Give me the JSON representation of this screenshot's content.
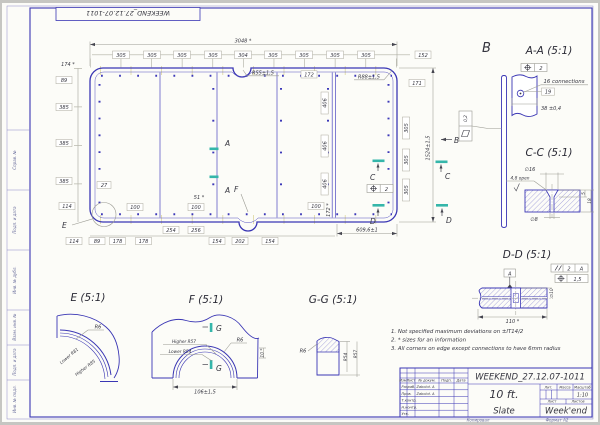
{
  "stamp": "WEEKEND_27.12.07-1011",
  "labels": {
    "a": "A",
    "b": "B",
    "c": "C",
    "d": "D",
    "e": "E",
    "f": "F",
    "g": "G"
  },
  "dims": {
    "overall_width": "3048 *",
    "top_row": [
      "305",
      "305",
      "305",
      "305",
      "304",
      "305",
      "305",
      "305",
      "305"
    ],
    "top_right": "152",
    "right_171": "171",
    "left_174": "174 *",
    "left_89": "89",
    "left_385": "385",
    "left_27": "27",
    "left_114": "114",
    "bottom_row": [
      "114",
      "89",
      "178",
      "178"
    ],
    "mid_254": "254",
    "mid_256": "256",
    "bottom_154": "154",
    "bottom_202": "202",
    "bottom_right": "609,6±1",
    "v172": "172 *",
    "t172": "172",
    "d100": "100",
    "d51": "51 *",
    "d406": "406",
    "r305": "305",
    "overall_height": "1524±1,5",
    "r55": "R55±1,5",
    "r88": "R88±1,5",
    "pos_tol": "2"
  },
  "view_b": {
    "flatness": "0,2"
  },
  "section_aa": {
    "title": "A-A (5:1)",
    "pos_tol": "2",
    "connections": "16 connections",
    "d19": "19",
    "d38": "38 ±0,4"
  },
  "section_cc": {
    "title": "C-C (5:1)",
    "d16": "∅16",
    "open": "4,8 open",
    "d8": "∅8",
    "t5": "5",
    "t18": "18"
  },
  "section_dd": {
    "title": "D-D (5:1)",
    "datum": "A",
    "par_val": "2",
    "par_ref": "A",
    "pos_val": "1,5",
    "d110": "110 *",
    "d10": "∅10"
  },
  "detail_e": {
    "title": "E (5:1)",
    "r6": "R6",
    "lower": "Lower R81",
    "higher": "Higher R85"
  },
  "detail_f": {
    "title": "F (5:1)",
    "higher": "Higher R57",
    "lower": "Lower R54",
    "r6": "R6",
    "d106": "106±1,5",
    "d10": "10 *"
  },
  "section_gg": {
    "title": "G-G (5:1)",
    "r6": "R6",
    "r54": "R54",
    "r57": "R57"
  },
  "notes": [
    "1. Not specified maximum deviations on ±IT14/2",
    "2. * sizes for an information",
    "3. All corners on edge except connections to have 6mm radius"
  ],
  "title_block": {
    "doc_number": "WEEKEND_27.12.07-1011",
    "part_name": "10 ft.",
    "material": "Slate",
    "company": "Week'end",
    "scale": "1:10",
    "col_izm": "Изм.",
    "col_list": "Лист",
    "col_doc": "№ докум.",
    "col_sign": "Подп.",
    "col_date": "Дата",
    "lit": "Лит.",
    "mass": "Масса",
    "scale_lbl": "Масштаб",
    "sheet_lbl": "Лист",
    "sheets_lbl": "Листов",
    "role_0": "Разраб.",
    "role_1": "Пров.",
    "role_2": "Т.контр.",
    "role_3": "Н.контр.",
    "role_4": "Утв.",
    "name_0": "Zabolot. A",
    "name_1": "Zabolot. A",
    "copied": "Копировал",
    "format": "Формат A2"
  },
  "margin": {
    "l0": "Справ. №",
    "l1": "Подп. и дата",
    "l2": "Инв. № дубл.",
    "l3": "Взам. инв. №",
    "l4": "Подп. и дата",
    "l5": "Инв. № подл."
  }
}
